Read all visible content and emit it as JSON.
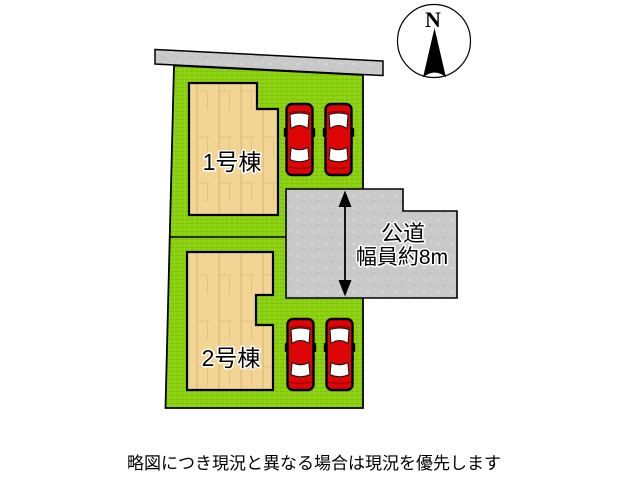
{
  "diagram": {
    "compass": {
      "label": "N"
    },
    "buildings": [
      {
        "label": "1号棟"
      },
      {
        "label": "2号棟"
      }
    ],
    "road": {
      "label_line1": "公道",
      "label_line2": "幅員約8m"
    },
    "caption": "略図につき現況と異なる場合は現況を優先します",
    "car_count": "4",
    "colors": {
      "lot_green": "#8cd110",
      "building_tan": "#f2d494",
      "road_gray": "#c9c9c9",
      "car_red": "#dd0505",
      "outline": "#000000",
      "background": "#ffffff"
    },
    "icons": {
      "north_compass": "north-compass-icon",
      "car": "car-icon",
      "width_arrow": "width-arrow-icon"
    }
  }
}
